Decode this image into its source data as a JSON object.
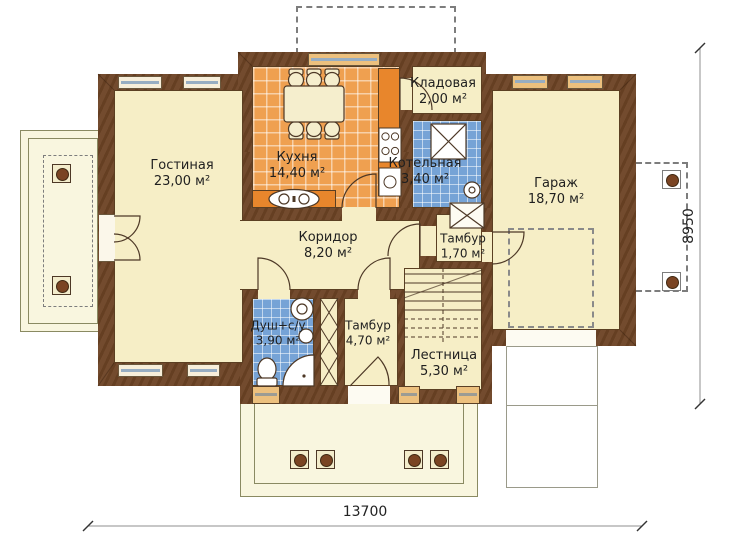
{
  "plan": {
    "type": "floor-plan",
    "language": "ru"
  },
  "rooms": [
    {
      "id": "living",
      "name": "Гостиная",
      "area": "23,00 м²"
    },
    {
      "id": "kitchen",
      "name": "Кухня",
      "area": "14,40 м²"
    },
    {
      "id": "storage",
      "name": "Кладовая",
      "area": "2,00 м²"
    },
    {
      "id": "boiler",
      "name": "Котельная",
      "area": "3,40 м²"
    },
    {
      "id": "garage",
      "name": "Гараж",
      "area": "18,70 м²"
    },
    {
      "id": "corridor",
      "name": "Коридор",
      "area": "8,20 м²"
    },
    {
      "id": "tambour-upper",
      "name": "Тамбур",
      "area": "1,70 м²"
    },
    {
      "id": "shower-wc",
      "name": "Душ+с/у",
      "area": "3,90 м²"
    },
    {
      "id": "tambour-lower",
      "name": "Тамбур",
      "area": "4,70 м²"
    },
    {
      "id": "stairs",
      "name": "Лестница",
      "area": "5,30 м²"
    }
  ],
  "dimensions": {
    "width": "13700",
    "depth": "8950"
  },
  "colors": {
    "wall": "#6d4425",
    "floor": "#f6eec6",
    "kitchen_tile": "#efa050",
    "wet_tile": "#76a3d6",
    "counter": "#e8862c",
    "terrace": "#f9f6df",
    "glass": "#97adc2"
  }
}
